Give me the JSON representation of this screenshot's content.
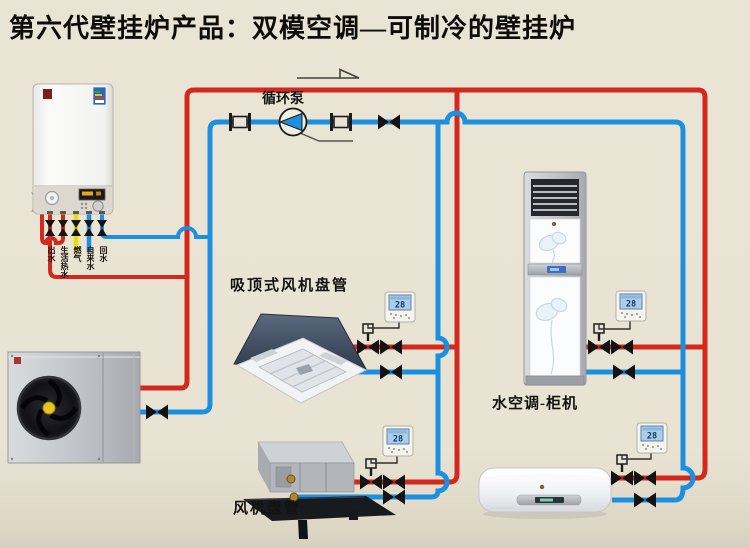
{
  "title": "第六代壁挂炉产品：双模空调—可制冷的壁挂炉",
  "labels": {
    "pump": "循环泵",
    "cassette": "吸顶式风机盘管",
    "floor_unit": "水空调-柜机",
    "fan_coil": "风机盘管"
  },
  "boiler_ports": [
    {
      "label": "出水",
      "color": "#d5281c"
    },
    {
      "label": "生活热水",
      "color": "#d5281c"
    },
    {
      "label": "燃气",
      "color": "#eedc00"
    },
    {
      "label": "自来水",
      "color": "#1b8fe0"
    },
    {
      "label": "回水",
      "color": "#1b8fe0"
    }
  ],
  "thermostats": [
    {
      "location": "cassette",
      "temp": "28"
    },
    {
      "location": "floor-unit",
      "temp": "28"
    },
    {
      "location": "fan-coil",
      "temp": "28"
    },
    {
      "location": "wall-unit",
      "temp": "28"
    }
  ],
  "colors": {
    "background": "#e9e3d3",
    "hot_pipe": "#d5281c",
    "cold_pipe": "#1b8fe0",
    "gas_pipe": "#eedc00"
  }
}
